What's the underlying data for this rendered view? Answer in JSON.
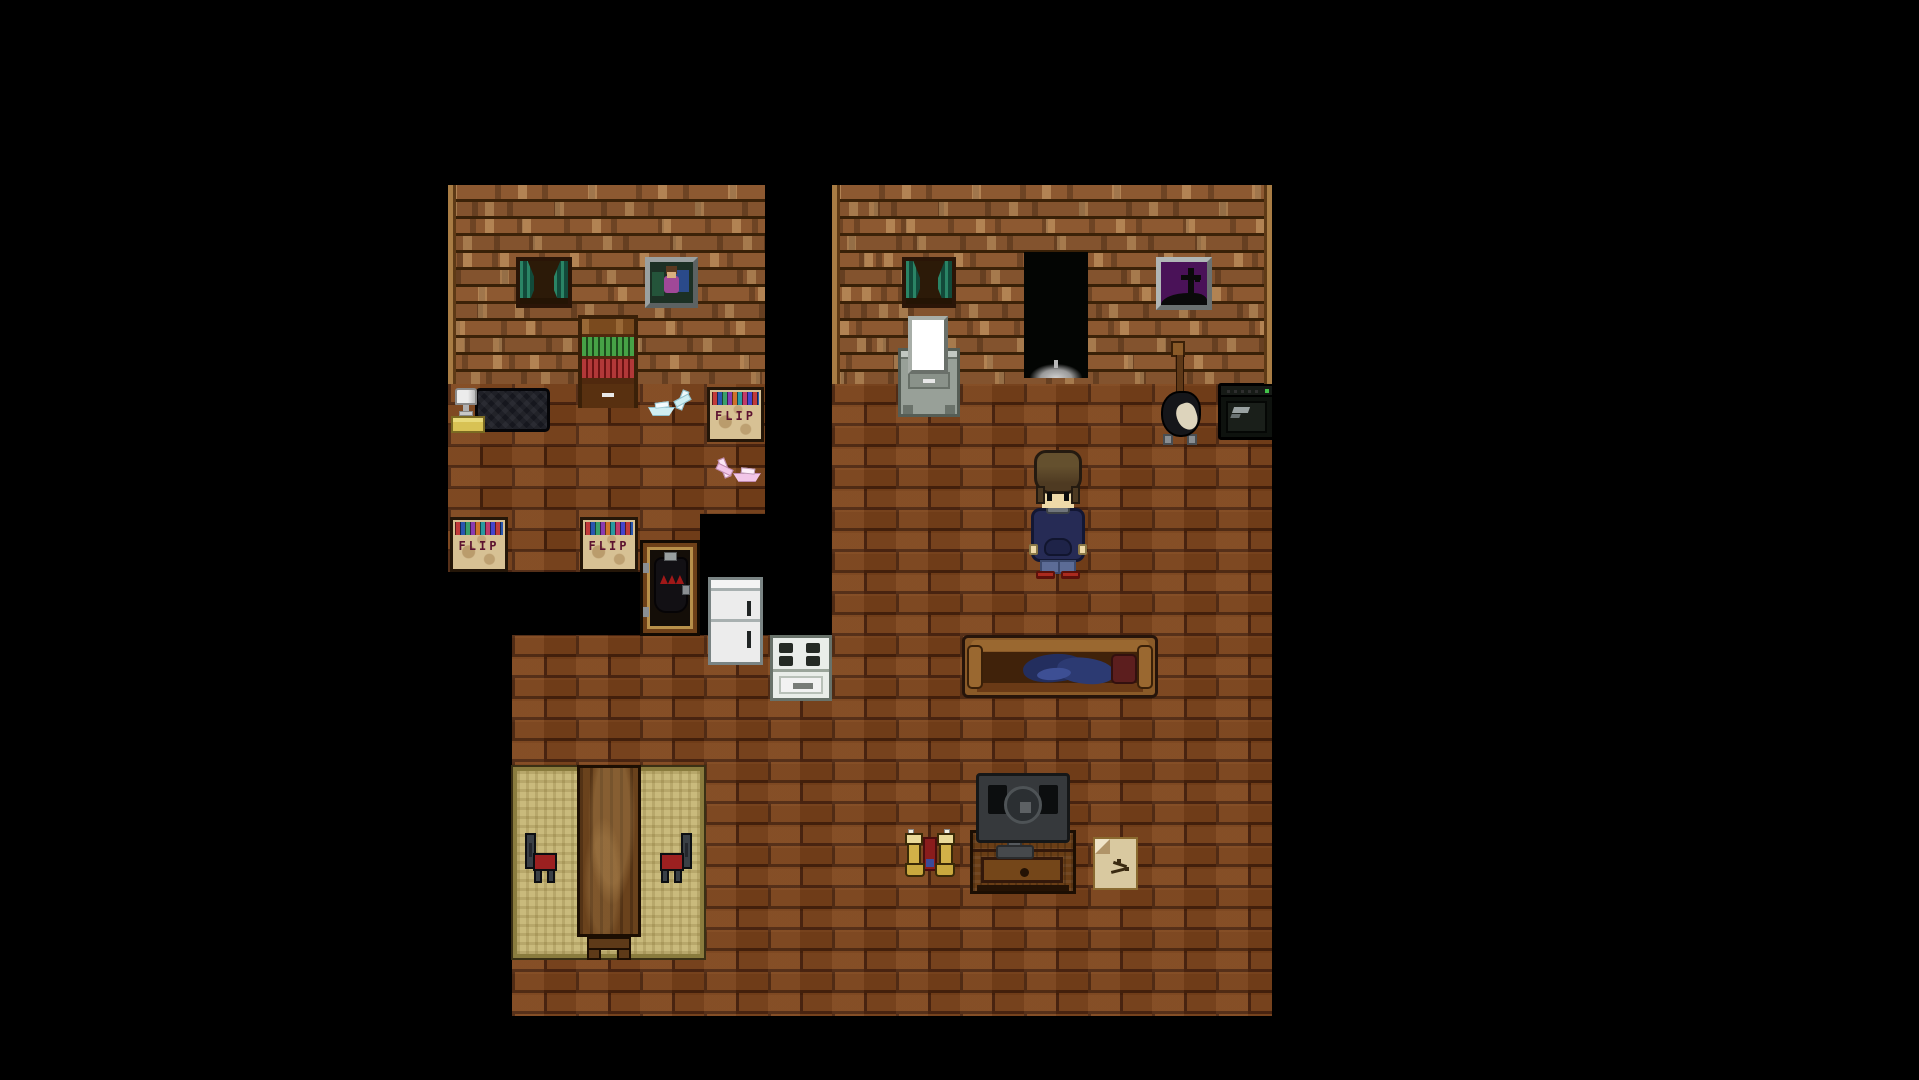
{
  "scene": {
    "description": "Top-down pixel-art house interior at night: left bedroom, right living room with player character, bottom kitchen-dining area, all on black void",
    "background": "#000000"
  },
  "labels": {
    "record_crate": "FLIP"
  },
  "palette": {
    "wall_wood": "#8d5931",
    "wall_seam": "#3c2208",
    "floor_brick": "#7c431b",
    "floor_mortar": "#4a220c",
    "curtain_teal": "#2a8465",
    "grave_picture_purple": "#4a1258",
    "crate_tan": "#d7c194",
    "crate_text_maroon": "#5c1230",
    "blanket_navy": "#232e5e",
    "pillow_maroon": "#5c1e1e",
    "hoodie_navy": "#262b55",
    "shoes_red": "#ab2a1e",
    "rug_tan": "#c9ba7c",
    "chair_seat_red": "#9c2020",
    "amp_led_green": "#42c24a"
  },
  "entities": {
    "player": "boy with messy brown hair, navy hoodie with gray collar, slate pants, red shoes, facing camera",
    "bedroom_left": [
      "window with teal curtains",
      "family photo in gray frame",
      "bookshelf with green and red books and drawer",
      "bed with dark navy blanket, lamp and yellow nightstand",
      "record crate labeled FLIP",
      "two record crates labeled FLIP at room edge",
      "blue origami bird and boat",
      "pink origami bird and boat",
      "wardrobe case holding black jacket with red zigzag"
    ],
    "living_room_right": [
      "window with teal curtains",
      "vanity mirror dresser",
      "dark open doorway with pale glow at threshold",
      "purple framed picture of a grave cross",
      "black electric guitar on stand",
      "black amplifier with green power light",
      "brown couch with crumpled navy blanket and dark red pillow",
      "flat-screen TV seen from behind on wooden cabinet with drawer",
      "pair of tan work boots with red item between",
      "beige note with dark scribble"
    ],
    "kitchen_bottom": [
      "white refrigerator",
      "white stove with four burners",
      "tan woven rug",
      "long wooden table with end bench",
      "two dark chairs with red seats"
    ]
  }
}
